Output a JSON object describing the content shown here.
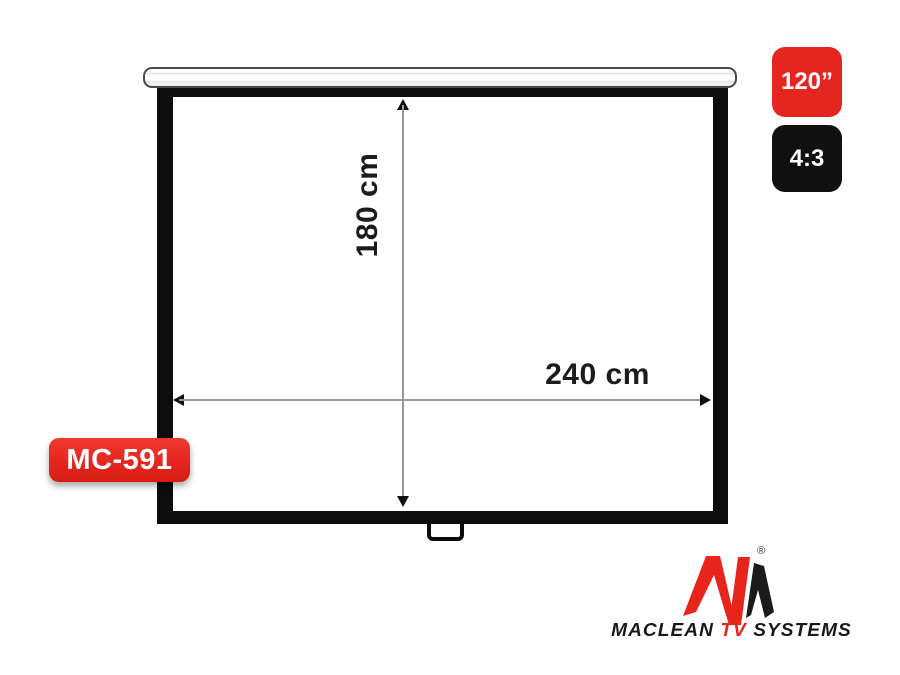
{
  "product": {
    "model_label": "MC-591",
    "type_hint": "projection-screen"
  },
  "badges": {
    "size": "120”",
    "ratio": "4:3"
  },
  "dimensions": {
    "height": "180 cm",
    "width": "240 cm"
  },
  "logo": {
    "brand_prefix": "MACLEAN",
    "brand_mid": "TV",
    "brand_suffix": "SYSTEMS",
    "registered": "®"
  },
  "colors": {
    "red": "#e52620",
    "black": "#101010",
    "line_gray": "#999999",
    "frame_black": "#0c0c0c"
  }
}
